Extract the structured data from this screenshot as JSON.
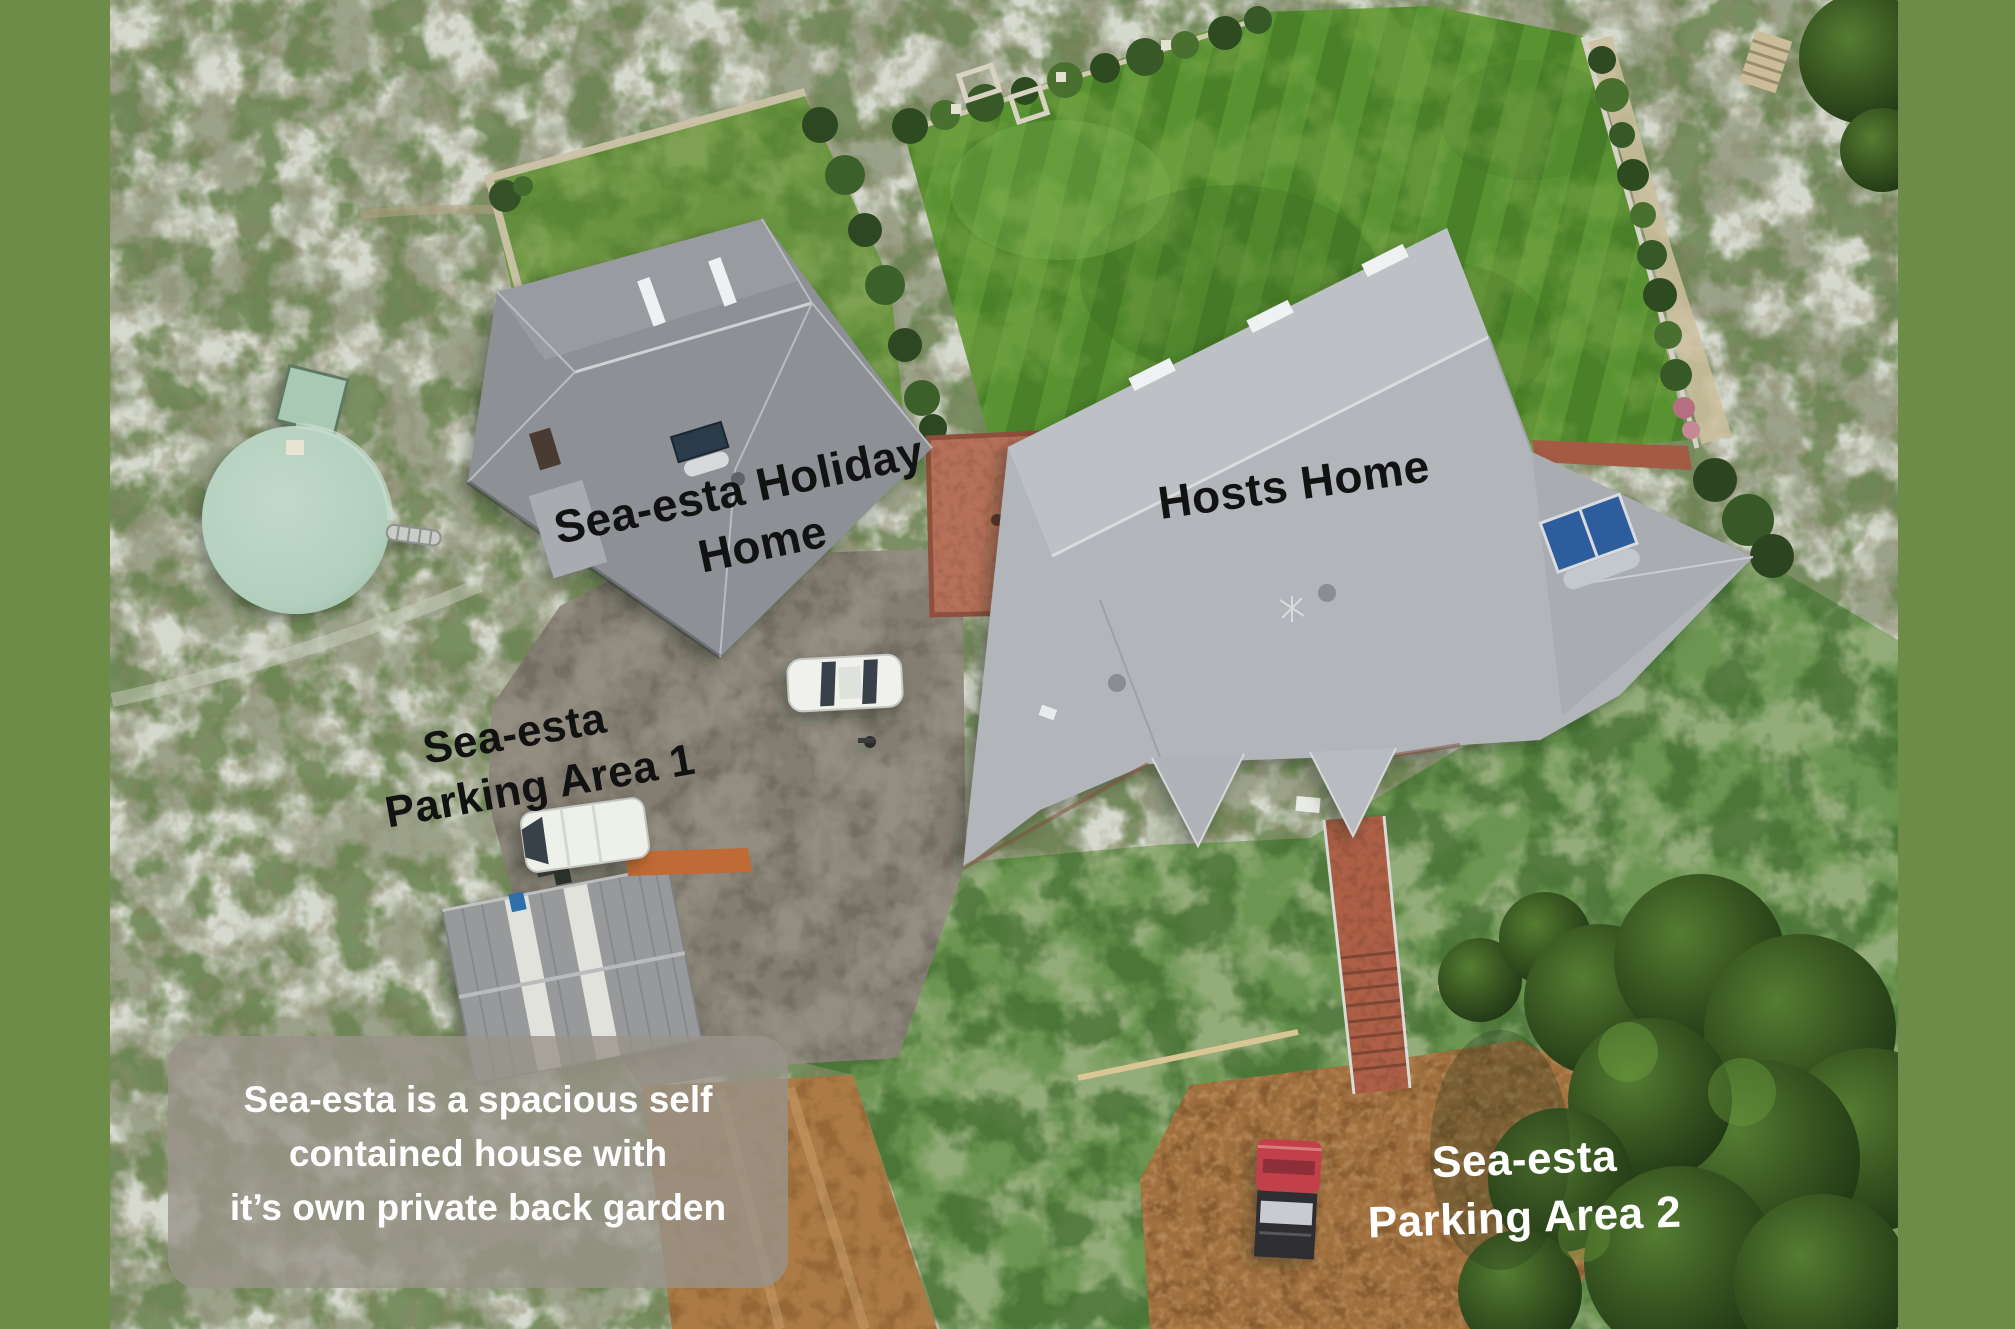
{
  "scene": {
    "description": "Aerial drone photo of the Sea-esta holiday property",
    "border_color": "#6d8c48"
  },
  "labels": {
    "holiday_home": {
      "line1": "Sea-esta Holiday",
      "line2": "Home",
      "color": "#121212"
    },
    "hosts_home": {
      "text": "Hosts Home",
      "color": "#121212"
    },
    "parking_area_1": {
      "line1": "Sea-esta",
      "line2": "Parking Area 1",
      "color": "#121212"
    },
    "parking_area_2": {
      "line1": "Sea-esta",
      "line2": "Parking Area 2",
      "color": "#ffffff"
    }
  },
  "caption": {
    "line1": "Sea-esta is a spacious self",
    "line2": "contained house with",
    "line3": "it’s own private back garden",
    "text_color": "#ffffff",
    "box_color": "rgba(152,147,138,0.8)"
  },
  "landmarks": [
    "holiday-home-roof",
    "hosts-home-roof",
    "garage-shed",
    "water-tank",
    "back-garden-lawn",
    "main-lawn",
    "courtyard",
    "brick-path",
    "parking-area-1",
    "parking-area-2",
    "dirt-road",
    "white-sedan",
    "white-van",
    "red-ute",
    "trees"
  ]
}
